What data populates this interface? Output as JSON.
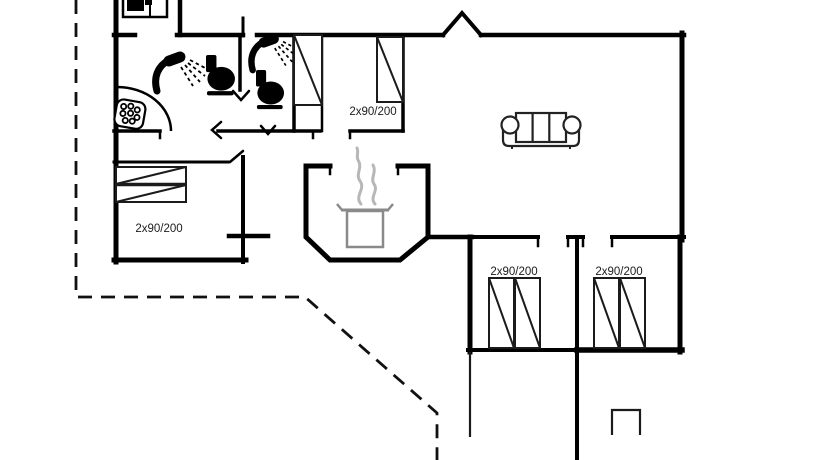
{
  "floorplan": {
    "title": "holiday-home-floor-plan",
    "labels": {
      "left_bunk_bed": "2x90/200",
      "top_bunk_bed": "2x90/200",
      "bedroom1_bed": "2x90/200",
      "bedroom2_bed": "2x90/200"
    },
    "colors": {
      "walls": "#000000",
      "background": "#ffffff",
      "furniture_line": "#1b1b1b",
      "pot": "#8a8a8a",
      "steam": "#b7b7b7",
      "boundary_dash": "#111111"
    },
    "icons": [
      "washer-icon",
      "shower-icon",
      "toilet-icon",
      "sink-bubbles-icon",
      "wardrobe-icon",
      "bunk-bed-icon",
      "double-bed-icon",
      "sofa-icon",
      "cooking-pot-icon",
      "steam-icon",
      "chimney-icon"
    ]
  }
}
